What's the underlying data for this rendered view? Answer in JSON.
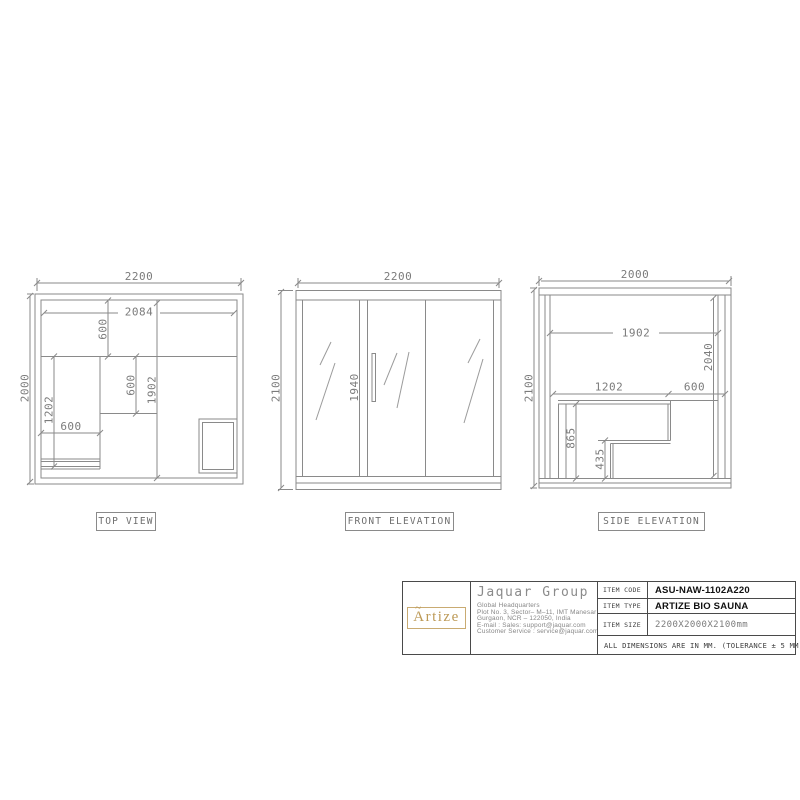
{
  "views": {
    "top": {
      "label": "TOP VIEW",
      "dims": {
        "width": "2200",
        "depth": "2000",
        "inner_width": "2084",
        "bench_depth": "600",
        "side_bench_length": "1202",
        "side_bench_width": "600",
        "walkway": "600",
        "inner_depth": "1902"
      }
    },
    "front": {
      "label": "FRONT ELEVATION",
      "dims": {
        "width": "2200",
        "height": "2100",
        "door_height": "1940"
      }
    },
    "side": {
      "label": "SIDE ELEVATION",
      "dims": {
        "width": "2000",
        "height": "2100",
        "inner_width": "1902",
        "inner_height": "2040",
        "bench_length": "1202",
        "bench_offset": "600",
        "bench_height": "865",
        "step_height": "435"
      }
    }
  },
  "title_block": {
    "logo": "Artize",
    "logo_accent": "~",
    "company": "Jaquar Group",
    "address": [
      "Global Headquarters",
      "Plot No. 3, Sector– M–11, IMT Manesar",
      "Gurgaon, NCR – 122050, India",
      "E-mail : Sales: support@jaquar.com",
      "Customer Service : service@jaquar.com"
    ],
    "rows": [
      {
        "label": "ITEM CODE",
        "value": "ASU-NAW-1102A220"
      },
      {
        "label": "ITEM TYPE",
        "value": "ARTIZE BIO SAUNA"
      },
      {
        "label": "ITEM SIZE",
        "value": "2200X2000X2100mm"
      }
    ],
    "note": "ALL DIMENSIONS ARE IN MM. (TOLERANCE ± 5 MM)"
  },
  "colors": {
    "line": "#8a8a8a",
    "dim_text": "#7b7b7b",
    "gold": "#bd9a57",
    "value_text": "#111111"
  }
}
